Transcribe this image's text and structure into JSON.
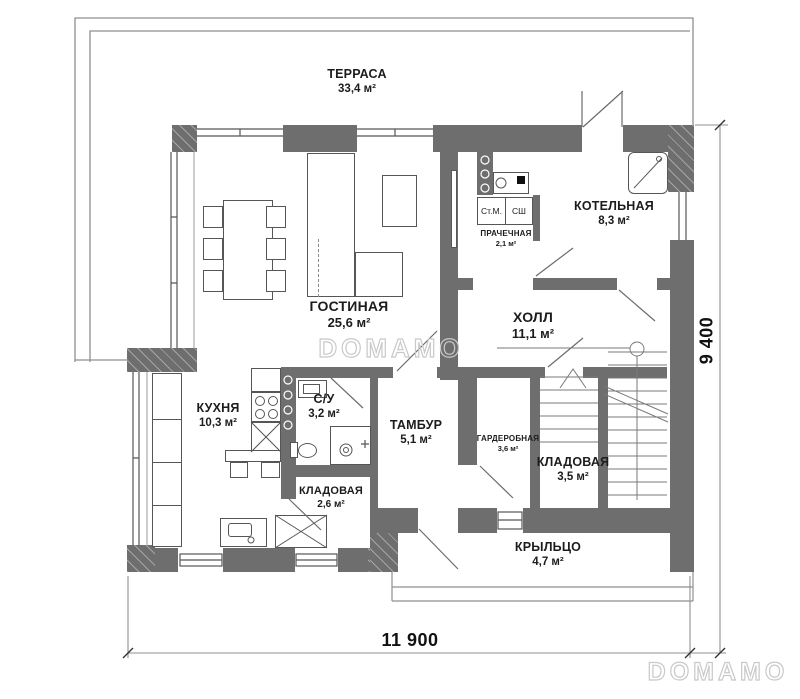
{
  "watermark": {
    "center": "DOMAMO",
    "corner": "DOMAMO"
  },
  "dimensions": {
    "width": "11 900",
    "height": "9 400"
  },
  "appliances": {
    "washer": "Ст.М.",
    "dryer": "СШ"
  },
  "rooms": [
    {
      "name": "ТЕРРАСА",
      "area": "33,4 м²"
    },
    {
      "name": "ГОСТИНАЯ",
      "area": "25,6 м²"
    },
    {
      "name": "КОТЕЛЬНАЯ",
      "area": "8,3 м²"
    },
    {
      "name": "ПРАЧЕЧНАЯ",
      "area": "2,1 м²"
    },
    {
      "name": "ХОЛЛ",
      "area": "11,1 м²"
    },
    {
      "name": "КУХНЯ",
      "area": "10,3 м²"
    },
    {
      "name": "С/У",
      "area": "3,2 м²"
    },
    {
      "name": "ТАМБУР",
      "area": "5,1 м²"
    },
    {
      "name": "ГАРДЕРОБНАЯ",
      "area": "3,6 м²"
    },
    {
      "name": "КЛАДОВАЯ",
      "area": "3,5 м²"
    },
    {
      "name": "КЛАДОВАЯ",
      "area": "2,6 м²"
    },
    {
      "name": "КРЫЛЬЦО",
      "area": "4,7 м²"
    }
  ],
  "colors": {
    "wall": "#6e6e6e",
    "line": "#565656",
    "thin_line": "#8f8f8f",
    "text": "#1c1c1c",
    "watermark_outline": "#c9c9c9",
    "background": "#ffffff"
  }
}
